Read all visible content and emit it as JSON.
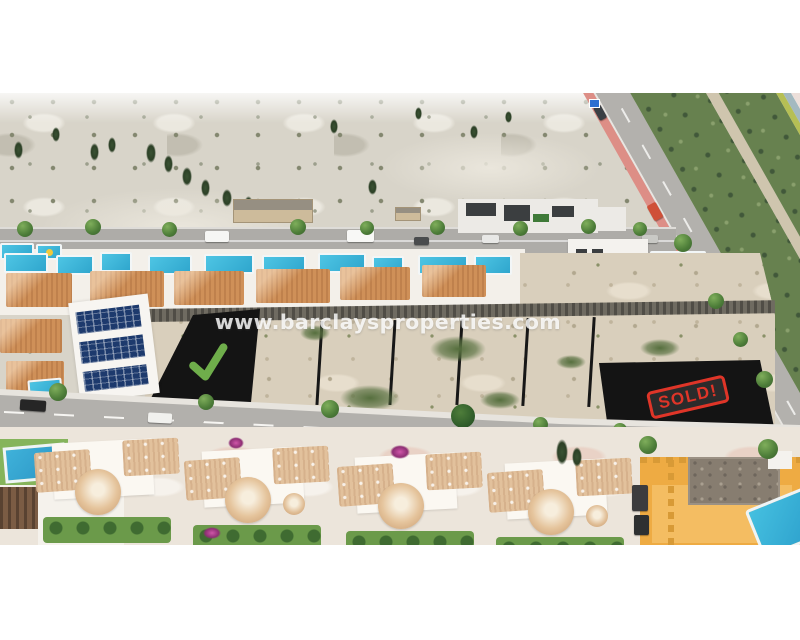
{
  "photo": {
    "kind": "aerial-drone-photograph",
    "subject": "Residential urbanisation with villas, swimming pools and building plots for sale beside a main road and scrubland",
    "watermark": {
      "text": "www.barclaysproperties.com",
      "color": "rgba(255,255,255,0.82)"
    },
    "annotations": {
      "available_plot": {
        "marker": "green-checkmark",
        "highlight_color": "#2fbde2",
        "checkmark_color": "#6fae4b"
      },
      "sold_plot": {
        "sold_label": "SOLD!",
        "stamp_color": "#df3528",
        "highlight_color": "#2fbde2"
      }
    },
    "palette": {
      "page_background": "#ffffff",
      "scrubland": "#d8d4c9",
      "plot_sand": "#d9cfbc",
      "plot_highlight": "#2fbde2",
      "pool_water": "#2fa6cd",
      "roof_terracotta": "#cf9058",
      "roof_pale": "#e2c19c",
      "road_asphalt": "#b2b0ac",
      "bike_lane_pink": "#dd8e86",
      "vegetation_green": "#67814f",
      "orange_villa": "#eeab43"
    },
    "regions": [
      "scrubland",
      "farmland-corner",
      "diagonal-main-road",
      "upper-villa-row",
      "building-plots",
      "street",
      "lower-villa-row",
      "orange-villa"
    ]
  }
}
